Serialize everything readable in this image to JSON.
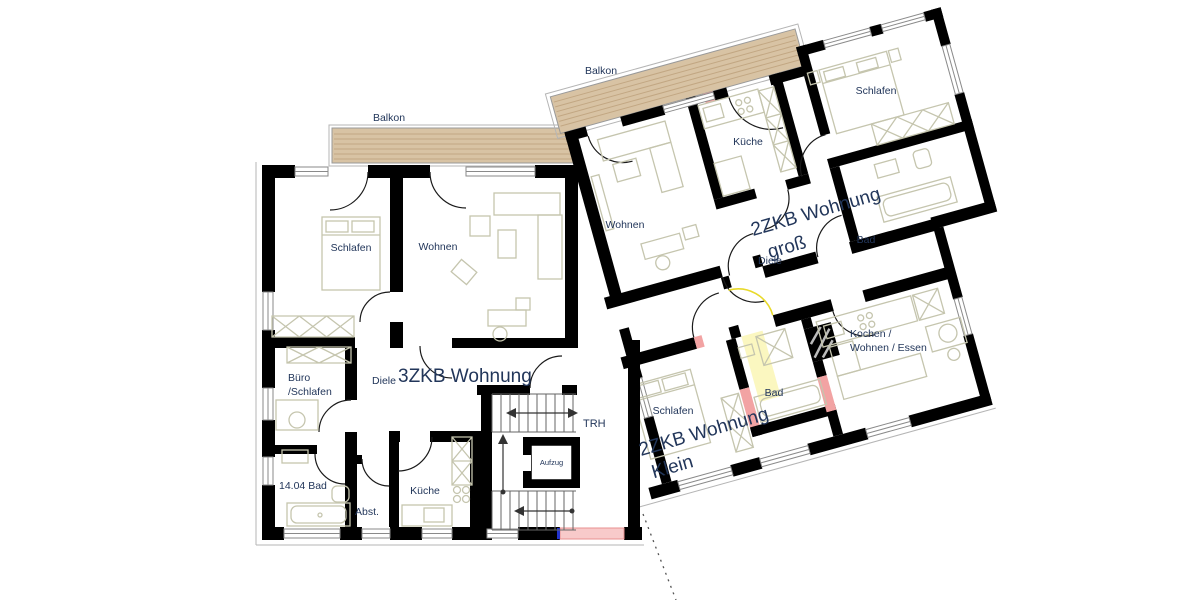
{
  "plan": {
    "balcony_left": "Balkon",
    "balcony_right": "Balkon",
    "apartment_3zkb": {
      "label": "3ZKB Wohnung",
      "color": "#17e4ee"
    },
    "apartment_2zkb_gross": {
      "label_line1": "2ZKB Wohnung",
      "label_line2": "groß",
      "color": "#2121f0"
    },
    "apartment_2zkb_klein": {
      "label_line1": "2ZKB Wohnung",
      "label_line2": "Klein",
      "color": "#e6352a"
    },
    "rooms_3zkb": {
      "schlafen": "Schlafen",
      "wohnen": "Wohnen",
      "buero_line1": "Büro",
      "buero_line2": "/Schlafen",
      "diele": "Diele",
      "bad": "14.04 Bad",
      "abstellraum": "Abst.",
      "kueche": "Küche"
    },
    "rooms_2zkb_gross": {
      "wohnen": "Wohnen",
      "kueche": "Küche",
      "schlafen": "Schlafen",
      "diele": "Diele",
      "bad": "Bad"
    },
    "rooms_2zkb_klein": {
      "schlafen": "Schlafen",
      "bad": "Bad",
      "kochen_line1": "Kochen /",
      "kochen_line2": "Wohnen / Essen"
    },
    "stairwell": {
      "trh": "TRH",
      "aufzug": "Aufzug"
    },
    "colors": {
      "wall": "#000000",
      "balcony_wood": "#d8c3a4",
      "wood_grain": "#c2a783",
      "furniture": "#c5c5ae",
      "room_label": "#22365a",
      "marker_pink": "#f2a3a3",
      "entry_pink": "#f8caca",
      "door_yellow": "#e8d92a",
      "path_yellow": "#fbf7c0"
    }
  }
}
